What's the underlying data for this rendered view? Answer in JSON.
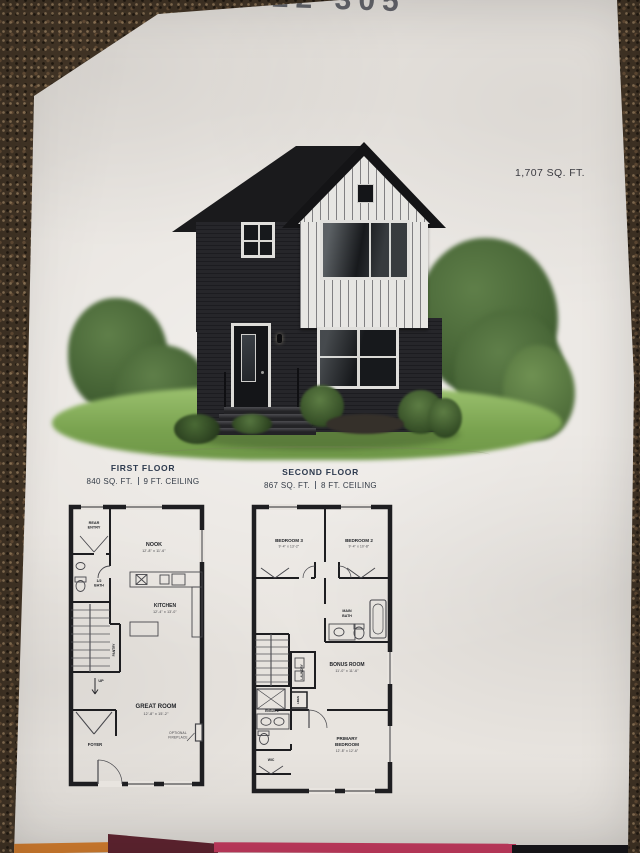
{
  "photo": {
    "handwritten_note": "22 305",
    "total_area": "1,707 SQ. FT."
  },
  "floors": {
    "first": {
      "title": "FIRST FLOOR",
      "area": "840 SQ. FT.",
      "ceiling": "9 FT. CEILING",
      "rooms": {
        "rear_entry": [
          "REAR",
          "ENTRY"
        ],
        "nook": "NOOK",
        "nook_dims": "12'-8\" x 11'-6\"",
        "half_bath": [
          "1/2",
          "BATH"
        ],
        "kitchen": "KITCHEN",
        "kitchen_dims": "12'-4\" x 13'-0\"",
        "pantry": "PANTRY",
        "up": "UP",
        "great_room": "GREAT ROOM",
        "great_room_dims": "12'-8\" x 15'-2\"",
        "foyer": "FOYER",
        "optional_fireplace": [
          "OPTIONAL",
          "FIREPLACE"
        ]
      }
    },
    "second": {
      "title": "SECOND FLOOR",
      "area": "867 SQ. FT.",
      "ceiling": "8 FT. CEILING",
      "rooms": {
        "bedroom3": "BEDROOM 3",
        "bedroom3_dims": "9'-4\" x 13'-2\"",
        "bedroom2": "BEDROOM 2",
        "bedroom2_dims": "9'-4\" x 10'-8\"",
        "main_bath": [
          "MAIN",
          "BATH"
        ],
        "laundry": "LAUNDRY",
        "linen": "LINEN",
        "bonus_room": "BONUS ROOM",
        "bonus_room_dims": "11'-0\" x 11'-6\"",
        "ensuite": "ENSUITE",
        "primary_bedroom": [
          "PRIMARY",
          "BEDROOM"
        ],
        "primary_bedroom_dims": "12'-8\" x 12'-6\"",
        "wic": "WIC"
      }
    }
  },
  "colors": {
    "paper": "#e8e4df",
    "carpet": "#403325",
    "plan_ink": "#1e1e21",
    "header_navy": "#2d3a4e",
    "roof": "#1a1a1c",
    "siding": "#222226",
    "gable_white": "#e7e6e3",
    "grass": "#85ad5c",
    "tree_green": "#4f6b3b",
    "band_orange": "#d07c2e",
    "band_maroon": "#5e2430",
    "band_magenta": "#c23a5e",
    "band_black": "#17161a"
  }
}
